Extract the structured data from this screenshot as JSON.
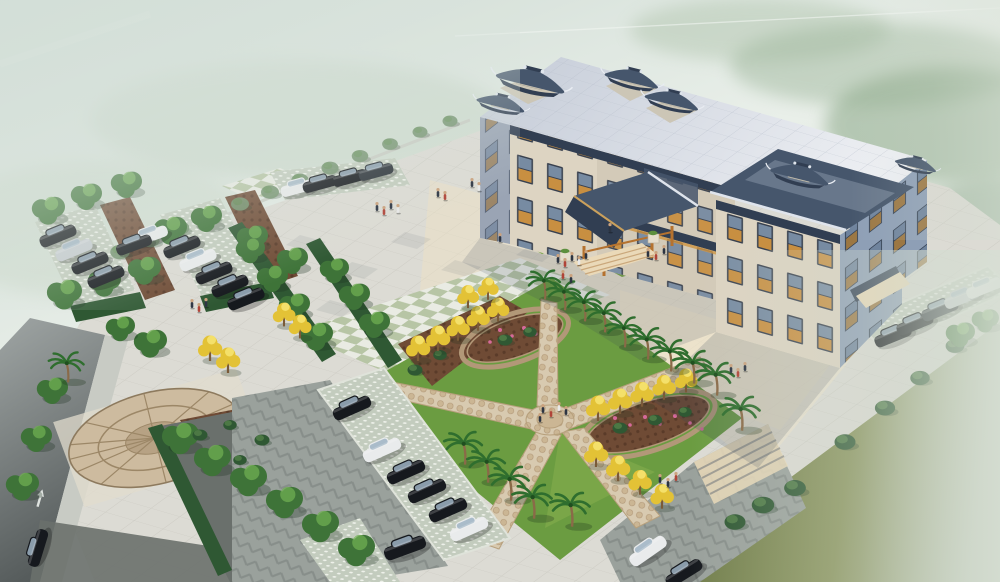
{
  "scene": {
    "type": "architectural-aerial-rendering",
    "description": "Bird's-eye 3D rendering of a Chinese-style government office building with grey tiled pagoda roofs, a large granite entrance plaza, landscaped gardens with X-shaped cobble paths, palm and golden ginkgo trees, and car parks with dark sedans, all fading into green mist.",
    "building": {
      "storeys": 4,
      "style": "Chinese hip roofs with upturned eaves",
      "roof_pavilions": 6,
      "entrance": "timber-columned gabled porte-cochere with stone steps",
      "window_screens": "orange wooden lattice"
    },
    "landscape": {
      "palm_trees": 16,
      "golden_trees": 20,
      "round_trees": 30,
      "boundary_shrubs": 19,
      "flower_beds": 2,
      "flower_color": "pink",
      "lawns": 6,
      "paving_features": [
        "green-white checker band",
        "circular cobble mosaic",
        "herringbone drive",
        "garden steps"
      ]
    },
    "parking": {
      "lots": 3,
      "cars_total": 30,
      "car_colors": [
        "black",
        "dark-grey",
        "silver",
        "white"
      ],
      "stall_surface": "grass-grid lattice pavers"
    },
    "roads": {
      "left_road_marking": "straight-ahead arrow",
      "moving_cars": 1
    },
    "people_groups": 9,
    "sky": "white-green haze with faint contrail"
  },
  "colors": {
    "fog_top": "#ccd9d2",
    "fog_light": "#e9efe9",
    "forest": "#7e9a7c",
    "roof_a": "#c4cbd7",
    "roof_b": "#edeff3",
    "pagoda": "#46566c",
    "pagoda_dark": "#313e52",
    "ridge_trim": "#dfe4ec",
    "stone": "#ccc6b6",
    "facade_cream": "#ddd4c2",
    "facade_cream2": "#d3cab8",
    "facade_shade": "#9aa4b4",
    "facade_blue": "#8e9fb6",
    "window_dark": "#39414f",
    "lattice_orange": "#cf9340",
    "glass": "#7d94ab",
    "canopy_wood": "#b5722f",
    "step_stone": "#ead9b8",
    "plaza_base": "#dcdbd4",
    "plaza_line": "#c9c7bf",
    "plaza_warm": "#f0e2c4",
    "checker_green": "#b7c5a5",
    "checker_white": "#e9ebe3",
    "lawn": "#6b9c41",
    "lawn_bright": "#7aa648",
    "field_a": "#6e7b4b",
    "field_b": "#b9c4b0",
    "mulch": "#6f4b35",
    "cobble": "#d8cab0",
    "cobble_edge": "#b29878",
    "hedge": "#2f5833",
    "tree_green": "#3e7338",
    "tree_yellow": "#e3c236",
    "palm_green": "#2f6e2e",
    "palm_trunk": "#8a6a48",
    "shrub_muted": "#6f8f6a",
    "road_a": "#9fa5a4",
    "road_b": "#555b5b",
    "curb": "#c8cbc4",
    "drive_dark": "#6a706c",
    "lattice_bg": "#c3ccbe",
    "herringbone": "#9aa19c",
    "car_black": "#16191e",
    "car_dark": "#2b3138",
    "car_silver": "#c6cbd0",
    "car_white": "#e9ebec",
    "shadow": "#2e3c55",
    "flower_pink": "#d66a9a",
    "people_dark": "#2c3442",
    "people_red": "#b04438",
    "people_white": "#e8e8e8"
  }
}
